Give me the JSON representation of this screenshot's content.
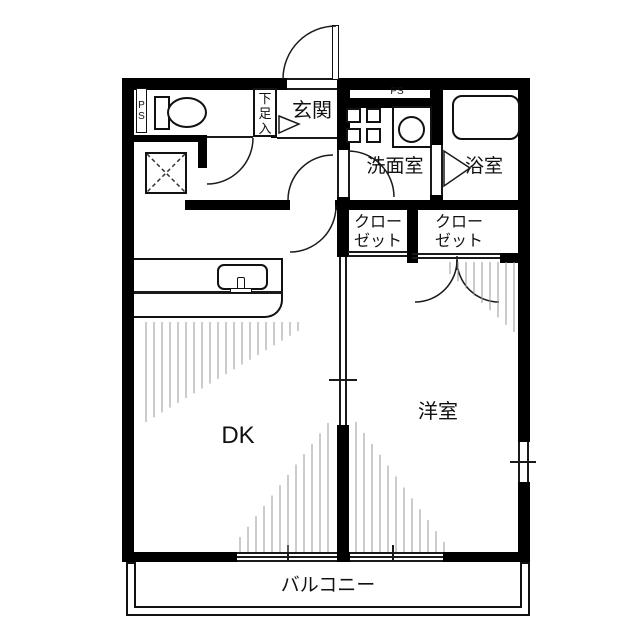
{
  "rooms": {
    "entrance": {
      "label": "玄関"
    },
    "shoe_cabinet": {
      "label": "下\n足\n入"
    },
    "pipe_space_left": {
      "label": "P\nS"
    },
    "pipe_space_top": {
      "label": "PS"
    },
    "washroom": {
      "label": "洗面室"
    },
    "bathroom": {
      "label": "浴室"
    },
    "closet_left": {
      "label": "クロー\nゼット"
    },
    "closet_right": {
      "label": "クロー\nゼット"
    },
    "dining_kitchen": {
      "label": "DK"
    },
    "western_room": {
      "label": "洋室"
    },
    "balcony": {
      "label": "バルコニー"
    }
  },
  "colors": {
    "wall": "#000000",
    "background": "#ffffff",
    "hatch": "#9a9a9a",
    "line": "#1a1a1a"
  }
}
